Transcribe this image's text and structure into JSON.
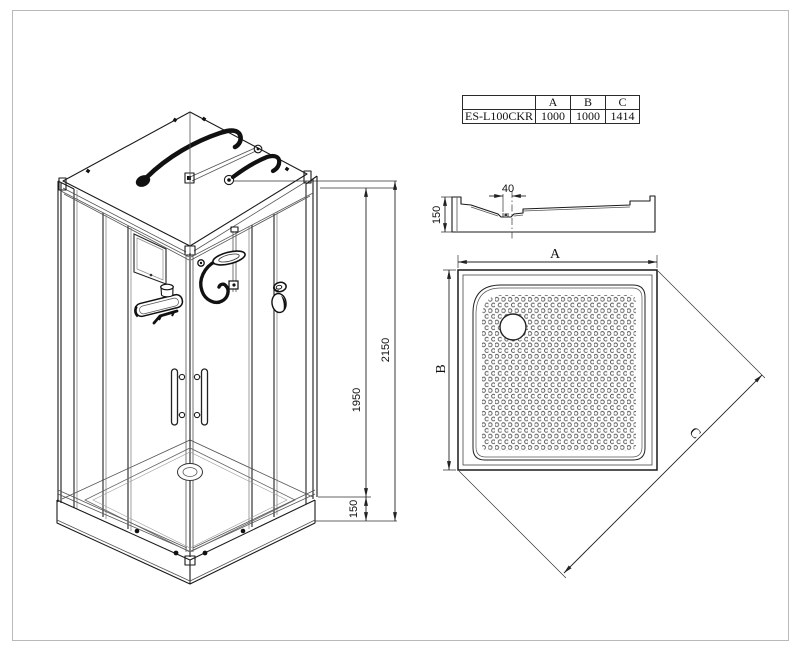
{
  "page": {
    "background": "#ffffff",
    "line_color": "#1a1a1a",
    "border_color": "#b9b9b9"
  },
  "spec_table": {
    "model_header": "",
    "col_headers": [
      "A",
      "B",
      "C"
    ],
    "rows": [
      {
        "model": "ES-L100CKR",
        "A": "1000",
        "B": "1000",
        "C": "1414"
      }
    ]
  },
  "iso_view": {
    "description": "isometric-shower-cabin",
    "dimensions": {
      "overall_height": "2150",
      "panel_height": "1950",
      "tray_height": "150"
    }
  },
  "section_view": {
    "description": "tray-cross-section",
    "dimensions": {
      "drain_offset": "40",
      "tray_height": "150"
    }
  },
  "plan_view": {
    "description": "tray-top-view",
    "dimension_labels": {
      "a": "A",
      "b": "B",
      "c": "C"
    }
  }
}
